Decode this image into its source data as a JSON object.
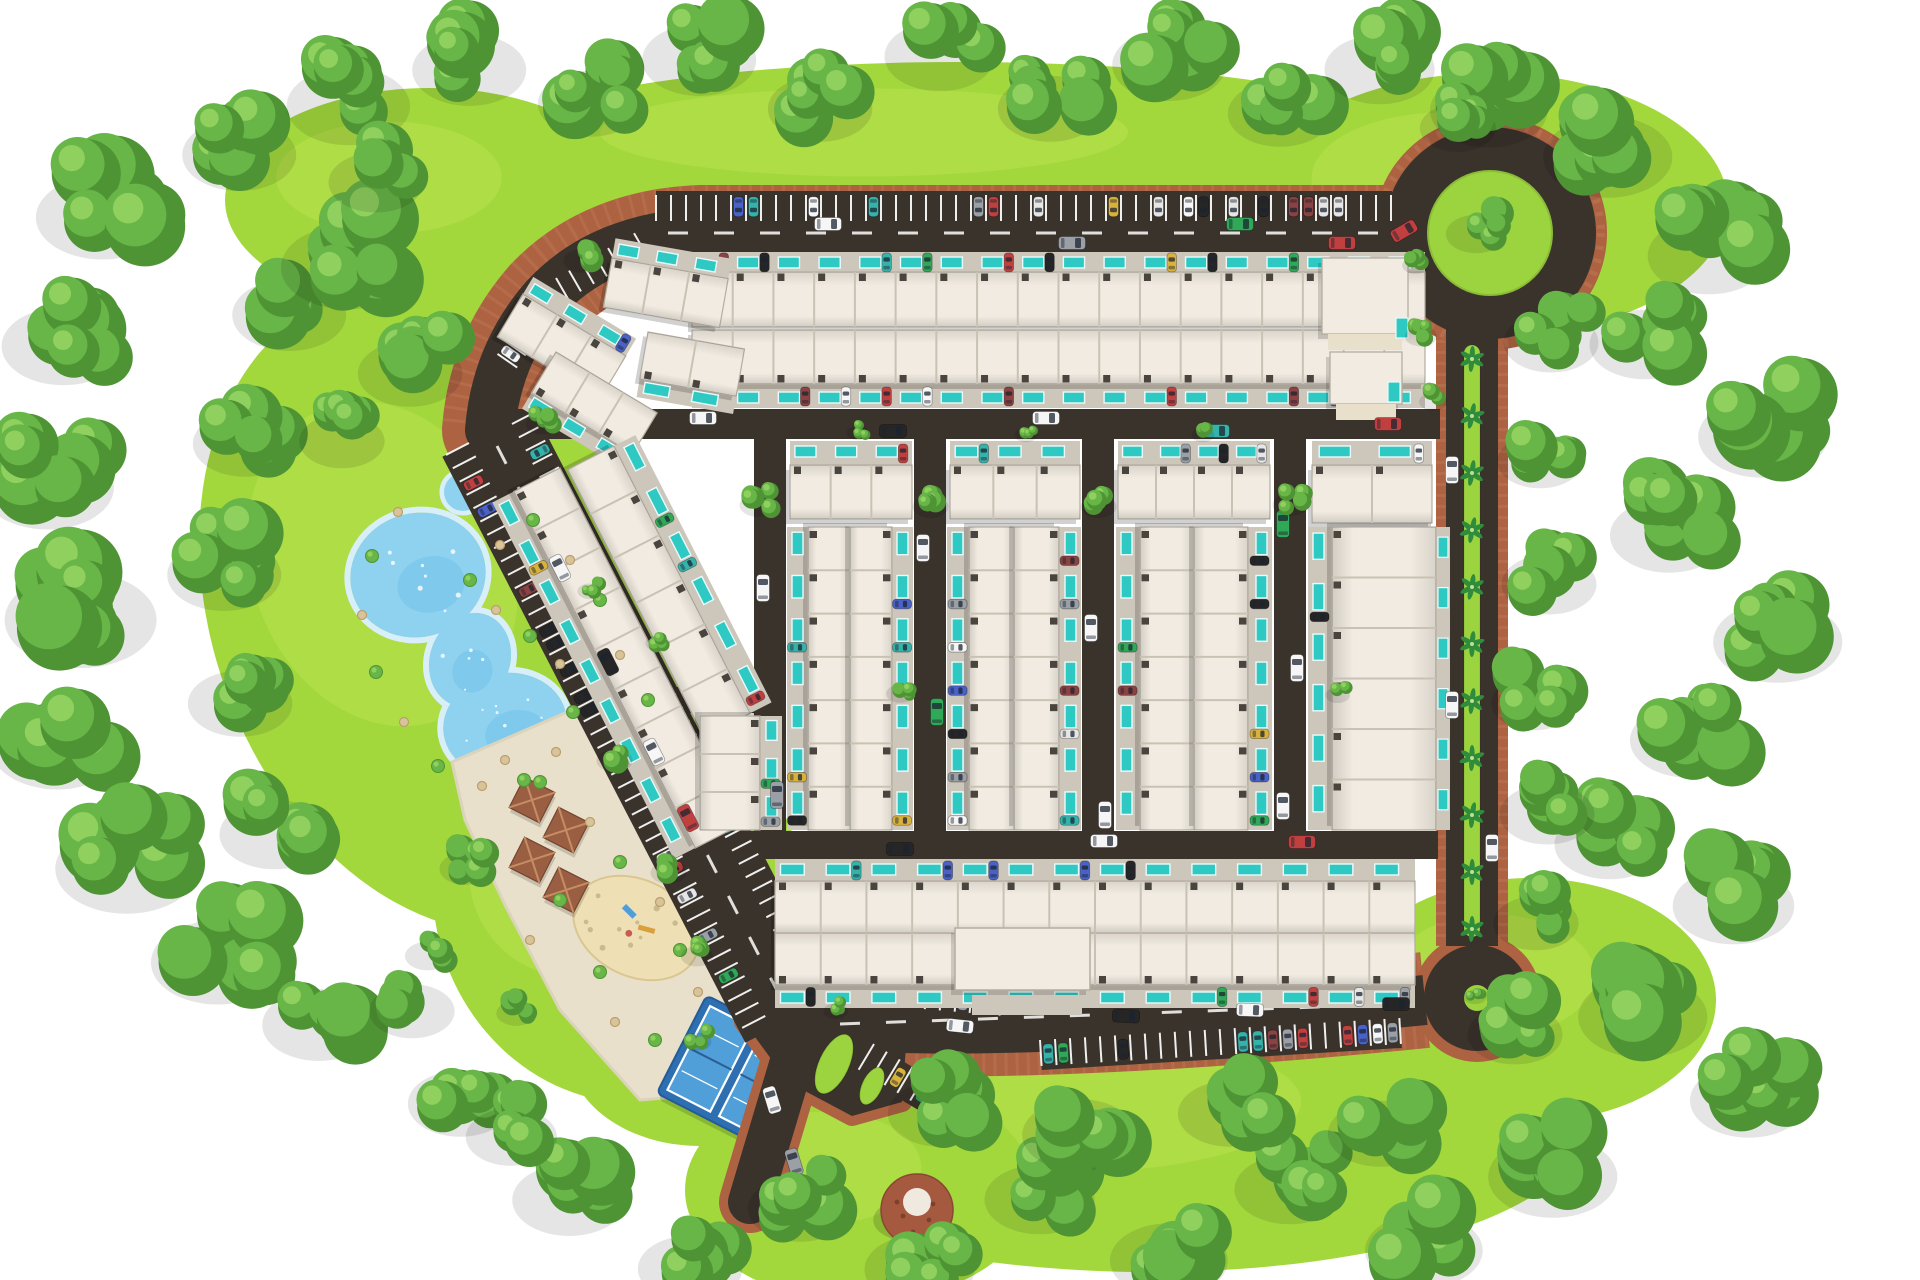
{
  "scene": {
    "w": 1920,
    "h": 1280
  },
  "colors": {
    "bg": "#ffffff",
    "lawn": "#a3d83d",
    "lawnLight": "#bfe452",
    "lawnDeep": "#8cc838",
    "treeDark": "#4e9434",
    "treeMid": "#68b548",
    "treeLight": "#8fd05e",
    "road": "#3a332c",
    "dash": "#f4f2ee",
    "brick": "#ad6342",
    "brickLight": "#c67f5b",
    "roof": "#f1ebe1",
    "roofLine": "#c9c2b4",
    "roofShadow": "#b4ada0",
    "wall": "#4a443e",
    "pad": "#cdc6ba",
    "pool": "#2fc9c4",
    "poolRim": "#e9fbfa",
    "pond": "#8ed2f0",
    "pondDeep": "#6fc0e8",
    "pondRim": "#d8effa",
    "sand": "#e9e0cb",
    "sandPlay": "#eedfb4",
    "deck": "#2e6fb2",
    "court": "#509fd8",
    "line": "#ffffff",
    "dome": "#a55a40",
    "domeCap": "#efe9df",
    "palm": "#2f8c3c",
    "island": "#9cd43f",
    "tan": "#d9c49a",
    "tanEdge": "#b99e6f",
    "carGlass": "#1c2430"
  },
  "carPalette": [
    "#f6f6f6",
    "#262626",
    "#9aa0a6",
    "#c04040",
    "#4a62c8",
    "#d9b23c",
    "#2fa857",
    "#e6e6e6",
    "#8a4242",
    "#35b3ab"
  ],
  "landscape": {
    "lawns": [
      [
        960,
        150,
        480,
        88,
        0
      ],
      [
        430,
        200,
        205,
        112,
        0
      ],
      [
        450,
        610,
        238,
        332,
        -20
      ],
      [
        620,
        900,
        185,
        205,
        -20
      ],
      [
        1490,
        205,
        238,
        132,
        0
      ],
      [
        1150,
        1130,
        432,
        142,
        0
      ],
      [
        860,
        1190,
        175,
        112,
        0
      ],
      [
        700,
        1050,
        132,
        96,
        0
      ],
      [
        1530,
        1000,
        186,
        122,
        0
      ]
    ],
    "treeClusters": [
      [
        115,
        200,
        70,
        6
      ],
      [
        75,
        330,
        65,
        6
      ],
      [
        60,
        470,
        70,
        6
      ],
      [
        95,
        600,
        80,
        7
      ],
      [
        70,
        730,
        70,
        6
      ],
      [
        140,
        850,
        75,
        7
      ],
      [
        230,
        945,
        70,
        6
      ],
      [
        330,
        1010,
        60,
        5
      ],
      [
        250,
        140,
        60,
        5
      ],
      [
        360,
        90,
        65,
        6
      ],
      [
        480,
        55,
        60,
        5
      ],
      [
        600,
        90,
        55,
        5
      ],
      [
        710,
        45,
        60,
        5
      ],
      [
        830,
        95,
        55,
        5
      ],
      [
        950,
        42,
        58,
        5
      ],
      [
        1060,
        95,
        55,
        5
      ],
      [
        1180,
        50,
        60,
        5
      ],
      [
        1290,
        100,
        55,
        5
      ],
      [
        1390,
        55,
        58,
        5
      ],
      [
        1500,
        95,
        62,
        6
      ],
      [
        1620,
        140,
        68,
        6
      ],
      [
        1720,
        240,
        64,
        6
      ],
      [
        1655,
        330,
        58,
        5
      ],
      [
        1775,
        420,
        68,
        6
      ],
      [
        1680,
        520,
        62,
        6
      ],
      [
        1790,
        625,
        68,
        6
      ],
      [
        1700,
        725,
        62,
        6
      ],
      [
        1620,
        830,
        58,
        6
      ],
      [
        1745,
        890,
        64,
        6
      ],
      [
        1655,
        1000,
        68,
        6
      ],
      [
        1760,
        1085,
        62,
        6
      ],
      [
        1565,
        1160,
        68,
        6
      ],
      [
        1435,
        1235,
        62,
        6
      ],
      [
        1300,
        1175,
        58,
        5
      ],
      [
        1180,
        1245,
        62,
        6
      ],
      [
        1050,
        1185,
        58,
        5
      ],
      [
        930,
        1255,
        58,
        5
      ],
      [
        810,
        1195,
        55,
        5
      ],
      [
        700,
        1255,
        55,
        5
      ],
      [
        580,
        1185,
        60,
        6
      ],
      [
        470,
        1090,
        55,
        5
      ],
      [
        520,
        1125,
        48,
        4
      ],
      [
        300,
        300,
        60,
        5
      ],
      [
        255,
        430,
        55,
        5
      ],
      [
        235,
        560,
        60,
        6
      ],
      [
        250,
        690,
        55,
        5
      ],
      [
        285,
        820,
        58,
        6
      ],
      [
        1465,
        118,
        40,
        4
      ],
      [
        1560,
        330,
        50,
        5
      ],
      [
        1548,
        450,
        45,
        4
      ],
      [
        1558,
        572,
        50,
        5
      ],
      [
        1542,
        692,
        45,
        4
      ],
      [
        1556,
        802,
        50,
        5
      ],
      [
        1544,
        912,
        45,
        4
      ],
      [
        1524,
        1022,
        50,
        5
      ],
      [
        420,
        1000,
        45,
        4
      ],
      [
        360,
        250,
        70,
        6
      ],
      [
        420,
        360,
        55,
        5
      ],
      [
        350,
        430,
        45,
        4
      ],
      [
        385,
        170,
        50,
        4
      ],
      [
        950,
        1100,
        55,
        5
      ],
      [
        1090,
        1120,
        60,
        5
      ],
      [
        1240,
        1100,
        55,
        5
      ],
      [
        1390,
        1120,
        55,
        5
      ]
    ],
    "treeSingles": [
      [
        762,
        500,
        20
      ],
      [
        934,
        502,
        19
      ],
      [
        1102,
        502,
        19
      ],
      [
        1294,
        500,
        19
      ],
      [
        586,
        256,
        20
      ],
      [
        545,
        420,
        17
      ],
      [
        618,
        756,
        19
      ],
      [
        672,
        868,
        19
      ],
      [
        700,
        952,
        17
      ],
      [
        470,
        862,
        27
      ],
      [
        432,
        950,
        24
      ],
      [
        520,
        1008,
        21
      ],
      [
        903,
        690,
        15
      ],
      [
        1424,
        332,
        17
      ],
      [
        1436,
        398,
        15
      ],
      [
        838,
        1008,
        13
      ],
      [
        700,
        1038,
        15
      ],
      [
        1205,
        432,
        12
      ],
      [
        1028,
        432,
        12
      ],
      [
        1340,
        692,
        13
      ],
      [
        1482,
        226,
        32
      ],
      [
        1477,
        994,
        12
      ],
      [
        1418,
        262,
        14
      ],
      [
        860,
        430,
        12
      ],
      [
        592,
        588,
        13
      ],
      [
        660,
        640,
        13
      ]
    ],
    "scatter": [
      [
        398,
        512,
        0
      ],
      [
        372,
        556,
        1
      ],
      [
        362,
        615,
        0
      ],
      [
        376,
        672,
        1
      ],
      [
        404,
        722,
        0
      ],
      [
        438,
        766,
        1
      ],
      [
        482,
        786,
        0
      ],
      [
        524,
        780,
        1
      ],
      [
        556,
        752,
        0
      ],
      [
        573,
        712,
        1
      ],
      [
        560,
        664,
        0
      ],
      [
        530,
        636,
        1
      ],
      [
        496,
        610,
        0
      ],
      [
        470,
        580,
        1
      ],
      [
        500,
        545,
        0
      ],
      [
        533,
        520,
        1
      ],
      [
        570,
        560,
        0
      ],
      [
        600,
        600,
        1
      ],
      [
        620,
        655,
        0
      ],
      [
        648,
        700,
        1
      ],
      [
        505,
        760,
        0
      ],
      [
        540,
        782,
        1
      ],
      [
        590,
        822,
        0
      ],
      [
        620,
        862,
        1
      ],
      [
        660,
        902,
        0
      ],
      [
        680,
        950,
        1
      ],
      [
        698,
        992,
        0
      ],
      [
        560,
        900,
        1
      ],
      [
        530,
        940,
        0
      ],
      [
        600,
        972,
        1
      ],
      [
        615,
        1022,
        0
      ],
      [
        655,
        1040,
        1
      ]
    ]
  },
  "water": {
    "pondBlobs": [
      [
        418,
        575,
        68,
        62,
        -15
      ],
      [
        470,
        660,
        40,
        48,
        20
      ],
      [
        505,
        725,
        62,
        52,
        -10
      ]
    ],
    "smallPond": [
      463,
      492,
      19
    ],
    "sparkleCount": 20
  },
  "plaza": {
    "poly": "452,762 618,690 664,742 700,806 760,972 770,1030 700,1095 640,1100 560,1010 505,905 465,820",
    "pavilions": [
      [
        532,
        800
      ],
      [
        566,
        830
      ],
      [
        532,
        860
      ],
      [
        566,
        890
      ]
    ],
    "pavSize": 34,
    "pavAngle": 27,
    "playground": {
      "x": 636,
      "y": 928,
      "rx": 66,
      "ry": 48,
      "rot": 27
    },
    "courts": {
      "x": 736,
      "y": 1072,
      "a": 27,
      "deckW": 122,
      "deckH": 110,
      "courtW": 48,
      "courtH": 94
    },
    "dome": {
      "x": 917,
      "y": 1210,
      "r": 36
    }
  },
  "roads": {
    "loop": "M 1412,233 L 702,233 C 640,235 585,255 545,298 C 512,336 494,380 490,430 L 793,1018 C 880,1038 1150,1028 1425,1000",
    "loopW": 50,
    "brickW": 96,
    "right": {
      "x": 1472,
      "y1": 318,
      "y2": 946,
      "w": 52,
      "brickW": 72
    },
    "median": {
      "x": 1464,
      "y": 345,
      "w": 16,
      "h": 592,
      "palmStep": 57
    },
    "streets": [
      [
        505,
        424,
        1440,
        424,
        30
      ],
      [
        712,
        845,
        1438,
        845,
        28
      ],
      [
        615,
        700,
        762,
        700,
        26
      ],
      [
        770,
        420,
        770,
        835,
        32
      ],
      [
        930,
        420,
        930,
        835,
        32
      ],
      [
        1098,
        420,
        1098,
        835,
        32
      ],
      [
        1290,
        420,
        1290,
        835,
        32
      ]
    ],
    "roundabout": {
      "x": 1490,
      "y": 233,
      "r": 84,
      "ringW": 44,
      "brickR": 104,
      "brickW": 26,
      "islandR": 62
    },
    "culdesac": {
      "x": 1477,
      "y": 998,
      "roadR": 53,
      "brickR": 64,
      "islandR": 13
    },
    "entrance": {
      "junction": "756,986 846,1006 906,1046 902,1102 852,1116 788,1082 744,1022",
      "stub": [
        802,
        1028,
        750,
        1202
      ],
      "stubW": 44,
      "stubBrickW": 62,
      "islands": [
        [
          834,
          1064,
          15,
          32,
          25
        ],
        [
          872,
          1086,
          10,
          20,
          25
        ]
      ]
    },
    "dashes": [
      [
        668,
        233,
        1382,
        233
      ],
      [
        497,
        446,
        786,
        1008
      ],
      [
        840,
        1024,
        1400,
        1004
      ]
    ]
  },
  "parking": [
    [
      656,
      221,
      1392,
      221,
      26,
      -1,
      0.25
    ],
    [
      646,
      254,
      566,
      300,
      24,
      1,
      0.15
    ],
    [
      560,
      306,
      510,
      378,
      24,
      1,
      0.15
    ],
    [
      575,
      318,
      537,
      386,
      22,
      -1,
      0.12
    ],
    [
      469,
      443,
      772,
      1029,
      26,
      1,
      0.18
    ],
    [
      512,
      424,
      812,
      1006,
      22,
      -1,
      0.12
    ],
    [
      1040,
      1040,
      1400,
      1018,
      26,
      1,
      0.5
    ],
    [
      865,
      1004,
      1005,
      1016,
      22,
      -1,
      0.3
    ],
    [
      874,
      1044,
      968,
      1100,
      30,
      1,
      0.45
    ]
  ],
  "housing": {
    "strips": [
      {
        "x": 692,
        "y": 272,
        "a": 0,
        "len": 733,
        "d": 55,
        "u": 18,
        "pool": "n",
        "m": 20,
        "cp": 0.5
      },
      {
        "x": 692,
        "y": 330,
        "a": 0,
        "len": 733,
        "d": 54,
        "u": 18,
        "pool": "s",
        "m": 24,
        "cp": 0.5
      },
      {
        "x": 612,
        "y": 258,
        "a": 10,
        "len": 118,
        "d": 50,
        "u": 3,
        "pool": "n",
        "m": 20,
        "cp": 0.3
      },
      {
        "x": 523,
        "y": 294,
        "a": 31,
        "len": 120,
        "d": 50,
        "u": 3,
        "pool": "n",
        "m": 20,
        "cp": 0.3
      },
      {
        "x": 556,
        "y": 352,
        "a": 31,
        "len": 118,
        "d": 48,
        "u": 3,
        "pool": "s",
        "m": 18,
        "cp": 0.3
      },
      {
        "x": 648,
        "y": 332,
        "a": 10,
        "len": 98,
        "d": 48,
        "u": 2,
        "pool": "s",
        "m": 18,
        "cp": 0.3
      },
      {
        "x": 790,
        "y": 465,
        "a": 0,
        "len": 122,
        "d": 54,
        "u": 3,
        "pool": "n",
        "m": 24,
        "cp": 0.6
      },
      {
        "x": 950,
        "y": 465,
        "a": 0,
        "len": 130,
        "d": 54,
        "u": 3,
        "pool": "n",
        "m": 24,
        "cp": 0.6
      },
      {
        "x": 1118,
        "y": 465,
        "a": 0,
        "len": 152,
        "d": 54,
        "u": 4,
        "pool": "n",
        "m": 24,
        "cp": 0.6
      },
      {
        "x": 1312,
        "y": 465,
        "a": 0,
        "len": 120,
        "d": 58,
        "u": 2,
        "pool": "n",
        "m": 24,
        "cp": 0.6
      },
      {
        "x": 850,
        "y": 527,
        "a": 90,
        "len": 303,
        "d": 42,
        "u": 7,
        "pool": "s",
        "m": 21,
        "cp": 0.55
      },
      {
        "x": 892,
        "y": 527,
        "a": 90,
        "len": 303,
        "d": 42,
        "u": 7,
        "pool": "n",
        "m": 21,
        "cp": 0.55
      },
      {
        "x": 1014,
        "y": 527,
        "a": 90,
        "len": 303,
        "d": 45,
        "u": 7,
        "pool": "s",
        "m": 22,
        "cp": 0.55
      },
      {
        "x": 1059,
        "y": 527,
        "a": 90,
        "len": 303,
        "d": 45,
        "u": 7,
        "pool": "n",
        "m": 22,
        "cp": 0.55
      },
      {
        "x": 1194,
        "y": 527,
        "a": 90,
        "len": 303,
        "d": 54,
        "u": 7,
        "pool": "s",
        "m": 24,
        "cp": 0.55
      },
      {
        "x": 1248,
        "y": 527,
        "a": 90,
        "len": 303,
        "d": 54,
        "u": 7,
        "pool": "n",
        "m": 24,
        "cp": 0.55
      },
      {
        "x": 1436,
        "y": 527,
        "a": 90,
        "len": 303,
        "d": 104,
        "u": 6,
        "pool": "s",
        "m": 24,
        "cp": 0.5,
        "extra": {
          "side": "n",
          "m": 14,
          "pools": true,
          "cp": 0.25
        }
      },
      {
        "x": 560,
        "y": 468,
        "a": 63,
        "len": 400,
        "d": 52,
        "u": 9,
        "pool": "s",
        "m": 24,
        "cp": 0.5
      },
      {
        "x": 614,
        "y": 446,
        "a": 63,
        "len": 300,
        "d": 52,
        "u": 6,
        "pool": "n",
        "m": 24,
        "cp": 0.4
      },
      {
        "x": 760,
        "y": 716,
        "a": 90,
        "len": 114,
        "d": 60,
        "u": 3,
        "pool": "n",
        "m": 22,
        "cp": 0.4
      },
      {
        "x": 775,
        "y": 881,
        "a": 0,
        "len": 640,
        "d": 52,
        "u": 14,
        "pool": "n",
        "m": 22,
        "cp": 0.5
      },
      {
        "x": 775,
        "y": 933,
        "a": 0,
        "len": 640,
        "d": 52,
        "u": 14,
        "pool": "s",
        "m": 23,
        "cp": 0.5
      }
    ],
    "clubhouse": {
      "x": 955,
      "y": 928,
      "w": 135,
      "h": 62
    },
    "forecourt": {
      "x": 972,
      "y": 995,
      "w": 110,
      "h": 20
    },
    "villas": [
      [
        1322,
        258,
        86,
        76
      ],
      [
        1330,
        352,
        72,
        52
      ]
    ],
    "villaPools": [
      [
        1396,
        318
      ],
      [
        1388,
        382
      ]
    ]
  },
  "vehicles": [
    [
      828,
      224,
      90,
      0
    ],
    [
      1072,
      243,
      90,
      2
    ],
    [
      1240,
      224,
      90,
      6
    ],
    [
      1342,
      243,
      90,
      3
    ],
    [
      1404,
      231,
      60,
      3
    ],
    [
      703,
      418,
      90,
      0
    ],
    [
      893,
      431,
      90,
      1
    ],
    [
      1046,
      418,
      90,
      0
    ],
    [
      1216,
      431,
      90,
      9
    ],
    [
      1388,
      424,
      90,
      3
    ],
    [
      763,
      588,
      0,
      0
    ],
    [
      777,
      795,
      0,
      2
    ],
    [
      923,
      548,
      0,
      0
    ],
    [
      937,
      712,
      0,
      6
    ],
    [
      1091,
      628,
      0,
      0
    ],
    [
      1105,
      815,
      0,
      0
    ],
    [
      1283,
      524,
      0,
      6
    ],
    [
      1297,
      668,
      0,
      0
    ],
    [
      1283,
      806,
      0,
      0
    ],
    [
      1452,
      470,
      0,
      0
    ],
    [
      1452,
      705,
      0,
      0
    ],
    [
      1492,
      848,
      0,
      0
    ],
    [
      900,
      849,
      90,
      1
    ],
    [
      1104,
      841,
      90,
      0
    ],
    [
      1302,
      842,
      90,
      3
    ],
    [
      1126,
      1016,
      93,
      1
    ],
    [
      1250,
      1010,
      92,
      0
    ],
    [
      960,
      1026,
      96,
      0
    ],
    [
      1396,
      1004,
      90,
      1
    ],
    [
      772,
      1100,
      -17,
      0
    ],
    [
      794,
      1162,
      -17,
      2
    ],
    [
      560,
      568,
      -27,
      0
    ],
    [
      608,
      662,
      -27,
      1
    ],
    [
      654,
      752,
      -27,
      0
    ],
    [
      688,
      818,
      -27,
      3
    ]
  ]
}
